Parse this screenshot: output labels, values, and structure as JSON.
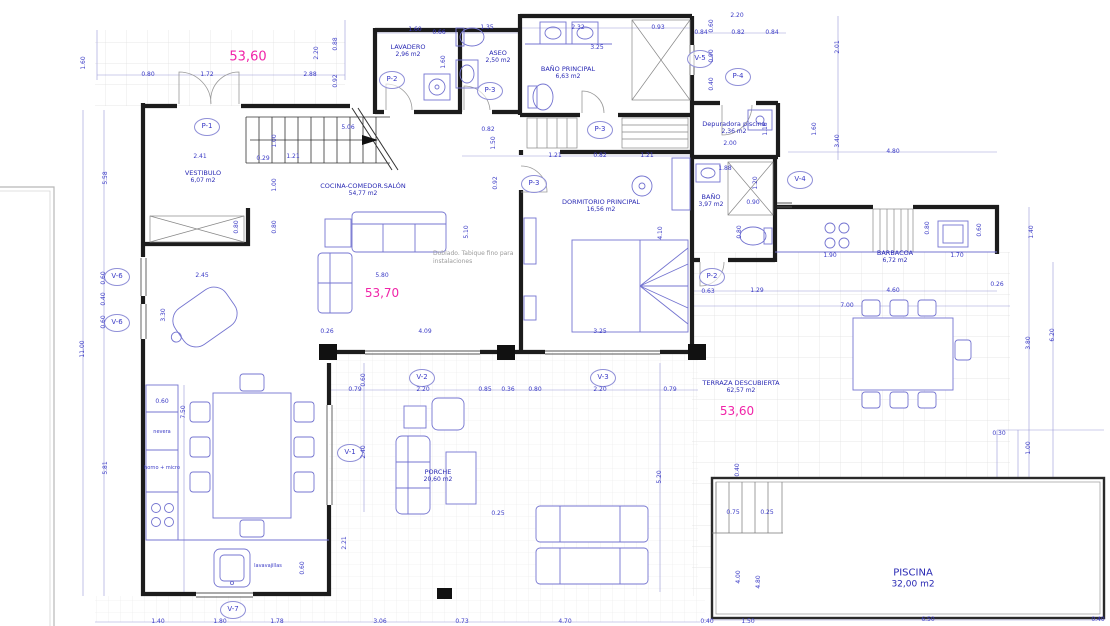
{
  "drawing": {
    "surface_labels": {
      "top_left": "53,60",
      "living": "53,70",
      "terrace": "53,60"
    },
    "note": "Doblado. Tabique fino para instalaciones",
    "rooms": {
      "vestibulo": {
        "name": "VESTIBULO",
        "area": "6,07 m2"
      },
      "salon": {
        "name": "COCINA-COMEDOR.SALÓN",
        "area": "54,77 m2"
      },
      "lavadero": {
        "name": "LAVADERO",
        "area": "2,96 m2"
      },
      "aseo": {
        "name": "ASEO",
        "area": "2,50 m2"
      },
      "bano_ppal": {
        "name": "BAÑO PRINCIPAL",
        "area": "6,63 m2"
      },
      "dormitorio": {
        "name": "DORMITORIO PRINCIPAL",
        "area": "16,56 m2"
      },
      "bano": {
        "name": "BAÑO",
        "area": "3,97 m2"
      },
      "barbacoa": {
        "name": "BARBACOA",
        "area": "6,72 m2"
      },
      "depuradora": {
        "name": "Depuradora piscina",
        "area": "2,36 m2"
      },
      "terraza": {
        "name": "TERRAZA DESCUBIERTA",
        "area": "62,57 m2"
      },
      "porche": {
        "name": "PORCHE",
        "area": "20,60 m2"
      },
      "piscina": {
        "name": "PISCINA",
        "area": "32,00 m2"
      }
    },
    "doors": {
      "p1": "P-1",
      "p2": "P-2",
      "p3": "P-3",
      "p4": "P-4"
    },
    "windows": {
      "v1": "V-1",
      "v2": "V-2",
      "v3": "V-3",
      "v4": "V-4",
      "v5": "V-5",
      "v6": "V-6",
      "v7": "V-7"
    },
    "kitchen": {
      "fridge": "nevera",
      "oven": "horno + micro",
      "dishwasher": "lavavajillas"
    },
    "dims": [
      "0.80",
      "1.72",
      "2.88",
      "2.20",
      "0.88",
      "0.92",
      "1.60",
      "0.66",
      "1.35",
      "2.32",
      "0.93",
      "3.25",
      "1.60",
      "2.20",
      "0.60",
      "0.84",
      "0.82",
      "0.84",
      "2.01",
      "0.90",
      "0.40",
      "2.00",
      "1.18",
      "1.60",
      "3.40",
      "4.80",
      "1.21",
      "0.82",
      "1.21",
      "0.82",
      "1.50",
      "0.92",
      "5.06",
      "1.00",
      "0.29",
      "1.21",
      "2.41",
      "1.60",
      "5.58",
      "11.00",
      "0.60",
      "0.40",
      "0.60",
      "5.81",
      "2.45",
      "5.80",
      "3.30",
      "1.00",
      "0.80",
      "0.80",
      "0.26",
      "4.09",
      "3.25",
      "5.10",
      "4.10",
      "1.88",
      "1.20",
      "0.90",
      "0.80",
      "0.63",
      "1.29",
      "4.60",
      "7.00",
      "0.26",
      "1.90",
      "1.70",
      "0.80",
      "0.60",
      "1.40",
      "3.80",
      "6.20",
      "0.30",
      "1.00",
      "0.79",
      "2.20",
      "0.85",
      "0.36",
      "0.80",
      "2.20",
      "0.79",
      "0.60",
      "2.40",
      "5.20",
      "7.50",
      "0.60",
      "0.60",
      "2.21",
      "0.25",
      "0.40",
      "0.75",
      "0.25",
      "4.00",
      "4.80",
      "1.50",
      "6.50",
      "0.40",
      "0.40",
      "1.40",
      "1.80",
      "1.78",
      "3.06",
      "0.73",
      "4.70"
    ],
    "colors": {
      "dim_text": "#3a3ac6",
      "area_text": "#f024a8",
      "wall": "#1c1c1c",
      "furniture": "#7474d0"
    }
  }
}
